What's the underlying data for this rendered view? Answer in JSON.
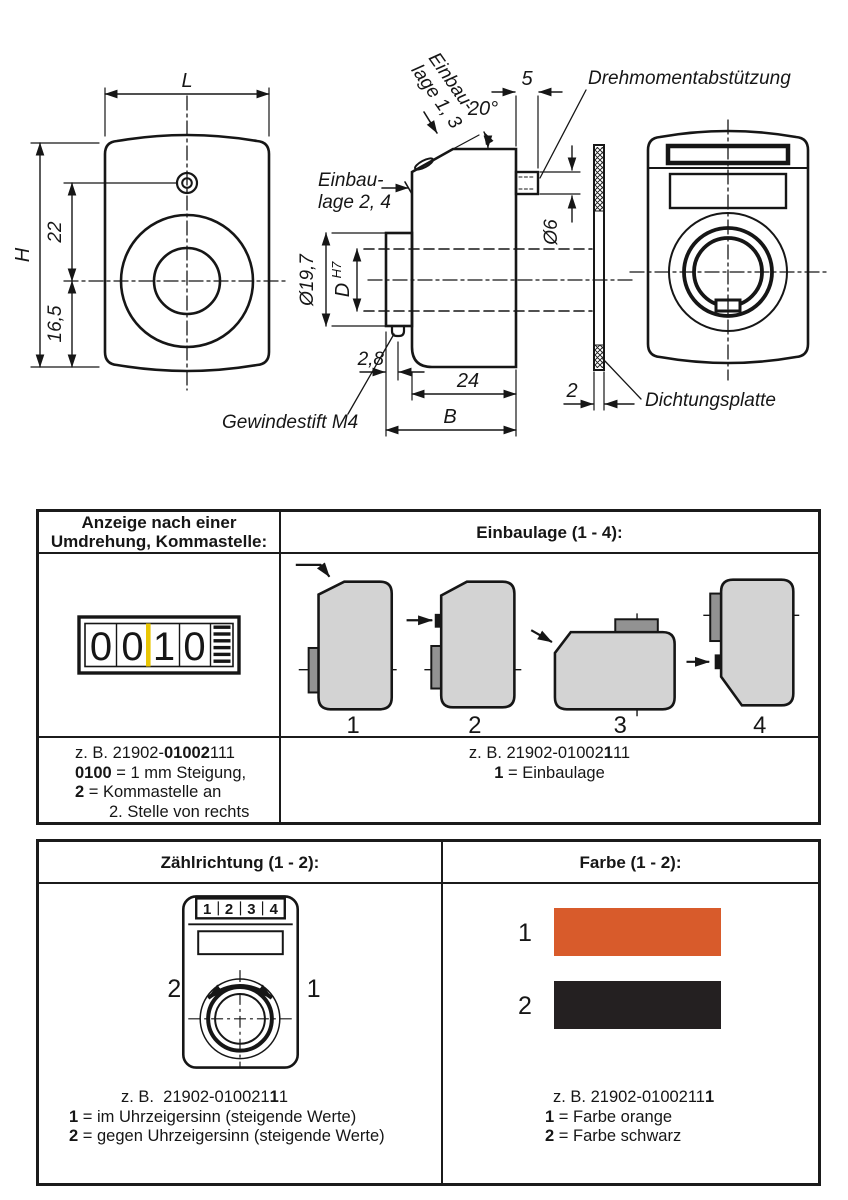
{
  "colors": {
    "orange": "#d85b2b",
    "swatch_black": "#242021",
    "comma_marker": "#e9c603",
    "shape_fill": "#d3d3d3",
    "tab_fill": "#929292"
  },
  "drawing": {
    "front": {
      "dim_L": "L",
      "dim_H": "H",
      "dim_22": "22",
      "dim_16_5": "16,5"
    },
    "side": {
      "einbaulage13_line1": "Einbau-",
      "einbaulage13_line2": "lage 1, 3",
      "einbaulage24_line1": "Einbau-",
      "einbaulage24_line2": "lage 2, 4",
      "dim_angle": "20°",
      "dim_5": "5",
      "dim_d6": "Ø6",
      "dim_d19_7": "Ø19,7",
      "dim_D": "D",
      "dim_D_tol": "H7",
      "dim_2_8": "2,8",
      "dim_24": "24",
      "dim_B": "B",
      "label_gewindestift": "Gewindestift M4",
      "label_drehmoment": "Drehmomentabstützung"
    },
    "plate": {
      "dim_2": "2",
      "label": "Dichtungsplatte"
    }
  },
  "table1": {
    "header_left": [
      "Anzeige nach einer",
      "Umdrehung, Kommastelle:"
    ],
    "header_right": "Einbaulage (1 - 4):",
    "counter_digits": [
      "0",
      "0",
      "1",
      "0"
    ],
    "positions": [
      "1",
      "2",
      "3",
      "4"
    ],
    "footer_left": {
      "l1_pre": "z. B. 21902-",
      "l1_bold": "01002",
      "l1_post": "111",
      "l2_bold": "0100",
      "l2_rest": " = 1 mm Steigung,",
      "l3_bold": "2",
      "l3_rest": " = Kommastelle an",
      "l4": "2. Stelle von rechts"
    },
    "footer_right": {
      "l1_pre": "z. B. 21902-01002",
      "l1_bold": "1",
      "l1_post": "11",
      "l2_bold": "1",
      "l2_rest": " = Einbaulage"
    }
  },
  "table2": {
    "header_left": "Zählrichtung (1 - 2):",
    "header_right": "Farbe (1 - 2):",
    "knob_digits": [
      "1",
      "2",
      "3",
      "4"
    ],
    "direction_labels": {
      "ccw": "2",
      "cw": "1"
    },
    "color_items": [
      {
        "num": "1",
        "label": "orange"
      },
      {
        "num": "2",
        "label": "schwarz"
      }
    ],
    "footer_left": {
      "l1_pre": "z. B.  21902-010021",
      "l1_bold": "1",
      "l1_post": "1",
      "l2_bold": "1",
      "l2_rest": " = im Uhrzeigersinn (steigende Werte)",
      "l3_bold": "2",
      "l3_rest": " = gegen Uhrzeigersinn (steigende Werte)"
    },
    "footer_right": {
      "l1_pre": "z. B. 21902-0100211",
      "l1_bold": "1",
      "l2_bold": "1",
      "l2_rest": " = Farbe orange",
      "l3_bold": "2",
      "l3_rest": " = Farbe schwarz"
    }
  }
}
